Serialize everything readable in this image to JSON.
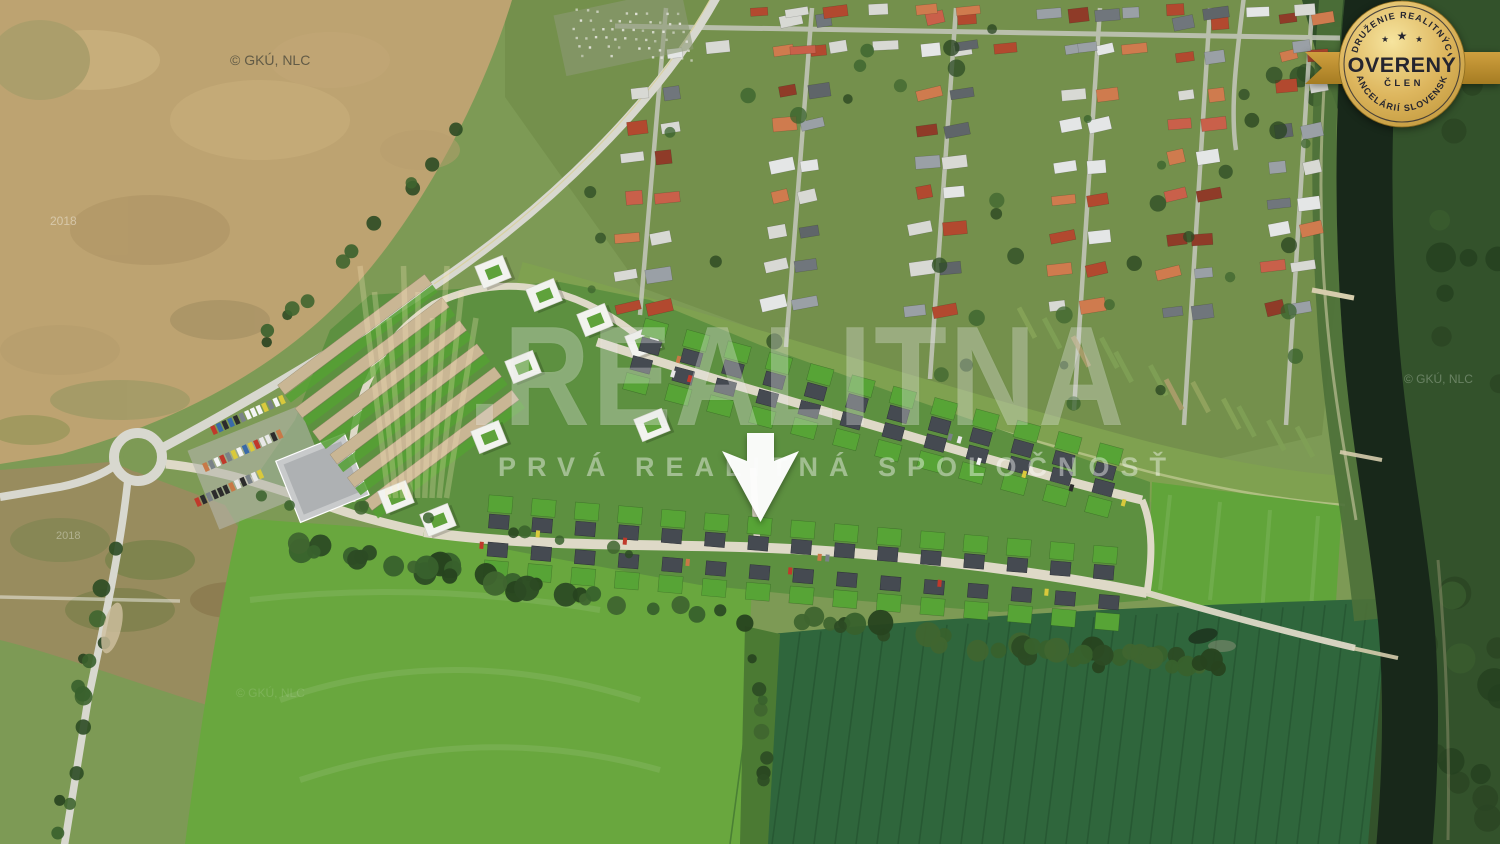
{
  "watermark": {
    "separator": ".",
    "brand": "REALITNA",
    "tagline": "PRVÁ REALITNÁ SPOLOČNOSŤ",
    "color": "#ffffff"
  },
  "badge": {
    "arc_top": "ZDRUŽENIE REALITNÝCH",
    "arc_bottom": "KANCELÁRIÍ SLOVENSKA",
    "title": "OVERENÝ",
    "subtitle": "ČLEN",
    "star": "★",
    "colors": {
      "gold_light": "#f6e49e",
      "gold": "#d4ab52",
      "gold_dark": "#a57c22",
      "text": "#25252f"
    }
  },
  "credits": [
    {
      "text": "© GKÚ, NLC"
    },
    {
      "text": "© GKÚ, NLC"
    },
    {
      "text": "© GKÚ, NLC"
    },
    {
      "text": "2018"
    },
    {
      "text": "2018"
    }
  ],
  "marker": {
    "icon": "down-arrow",
    "color": "#ffffff"
  }
}
